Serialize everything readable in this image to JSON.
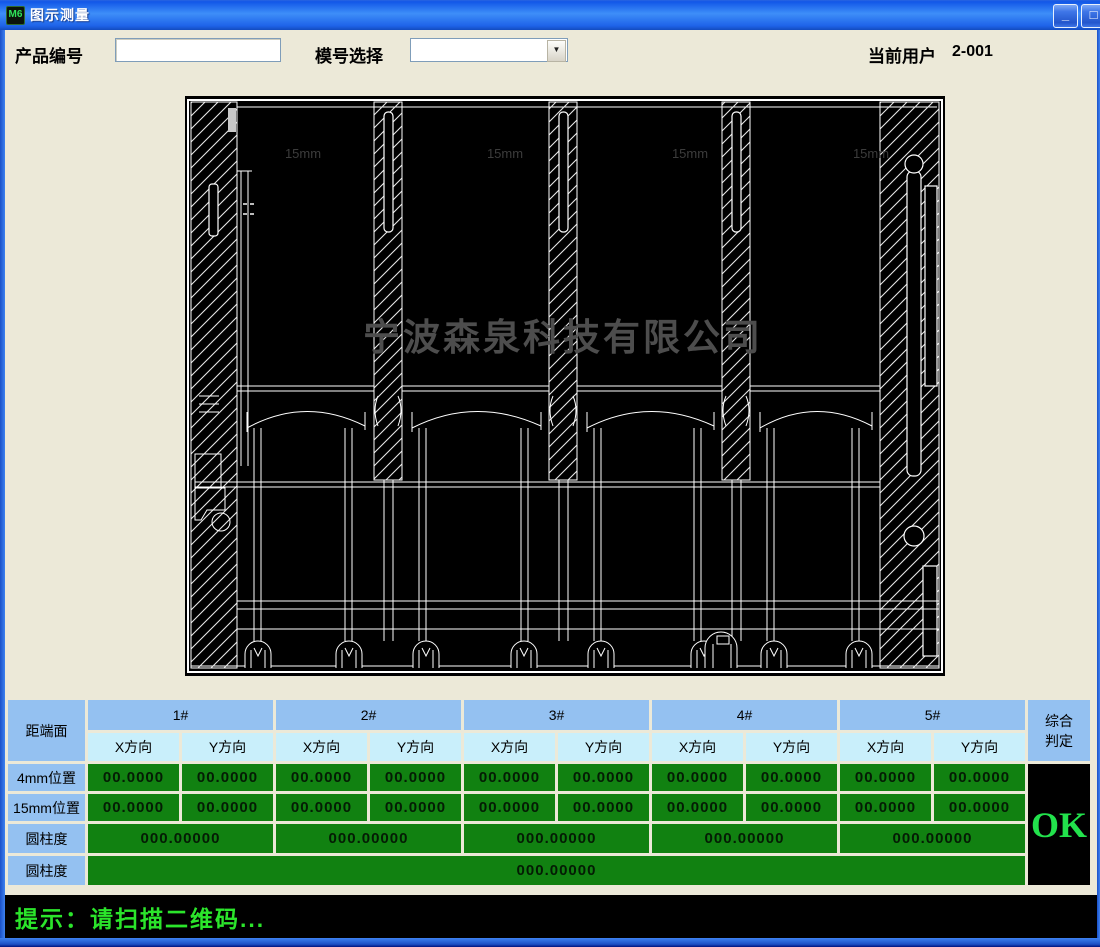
{
  "window": {
    "title": "图示测量",
    "icons": {
      "app_icon": "M6",
      "minimize": "_",
      "maximize": "□",
      "dropdown_arrow": "▼"
    }
  },
  "toolbar": {
    "product_label": "产品编号",
    "product_value": "",
    "product_placeholder": "",
    "mold_label": "模号选择",
    "mold_selected": "",
    "user_label": "当前用户",
    "user_value": "2-001"
  },
  "drawing": {
    "watermark": "宁波森泉科技有限公司",
    "dim_labels": [
      "15mm",
      "15mm",
      "15mm",
      "15mm"
    ]
  },
  "table": {
    "corner": "距端面",
    "groups": [
      "1#",
      "2#",
      "3#",
      "4#",
      "5#"
    ],
    "sub_headers": [
      "X方向",
      "Y方向"
    ],
    "rows": [
      {
        "label": "4mm位置",
        "values": [
          "00.0000",
          "00.0000",
          "00.0000",
          "00.0000",
          "00.0000",
          "00.0000",
          "00.0000",
          "00.0000",
          "00.0000",
          "00.0000"
        ]
      },
      {
        "label": "15mm位置",
        "values": [
          "00.0000",
          "00.0000",
          "00.0000",
          "00.0000",
          "00.0000",
          "00.0000",
          "00.0000",
          "00.0000",
          "00.0000",
          "00.0000"
        ]
      },
      {
        "label": "圆柱度",
        "values": [
          "000.00000",
          "000.00000",
          "000.00000",
          "000.00000",
          "000.00000"
        ]
      },
      {
        "label": "圆柱度",
        "value": "000.00000"
      }
    ],
    "verdict": {
      "line1": "综合",
      "line2": "判定",
      "value": "OK"
    }
  },
  "status": {
    "message": "提示：请扫描二维码..."
  },
  "colors": {
    "value_cell_green": "#118111",
    "ok_green": "#22E24C",
    "status_green": "#2BE52B",
    "header_blue": "#94C1F1",
    "header_cyan": "#C9EFFB",
    "titlebar_blue": "#1E63E9",
    "desktop_beige": "#ECE9D8"
  }
}
